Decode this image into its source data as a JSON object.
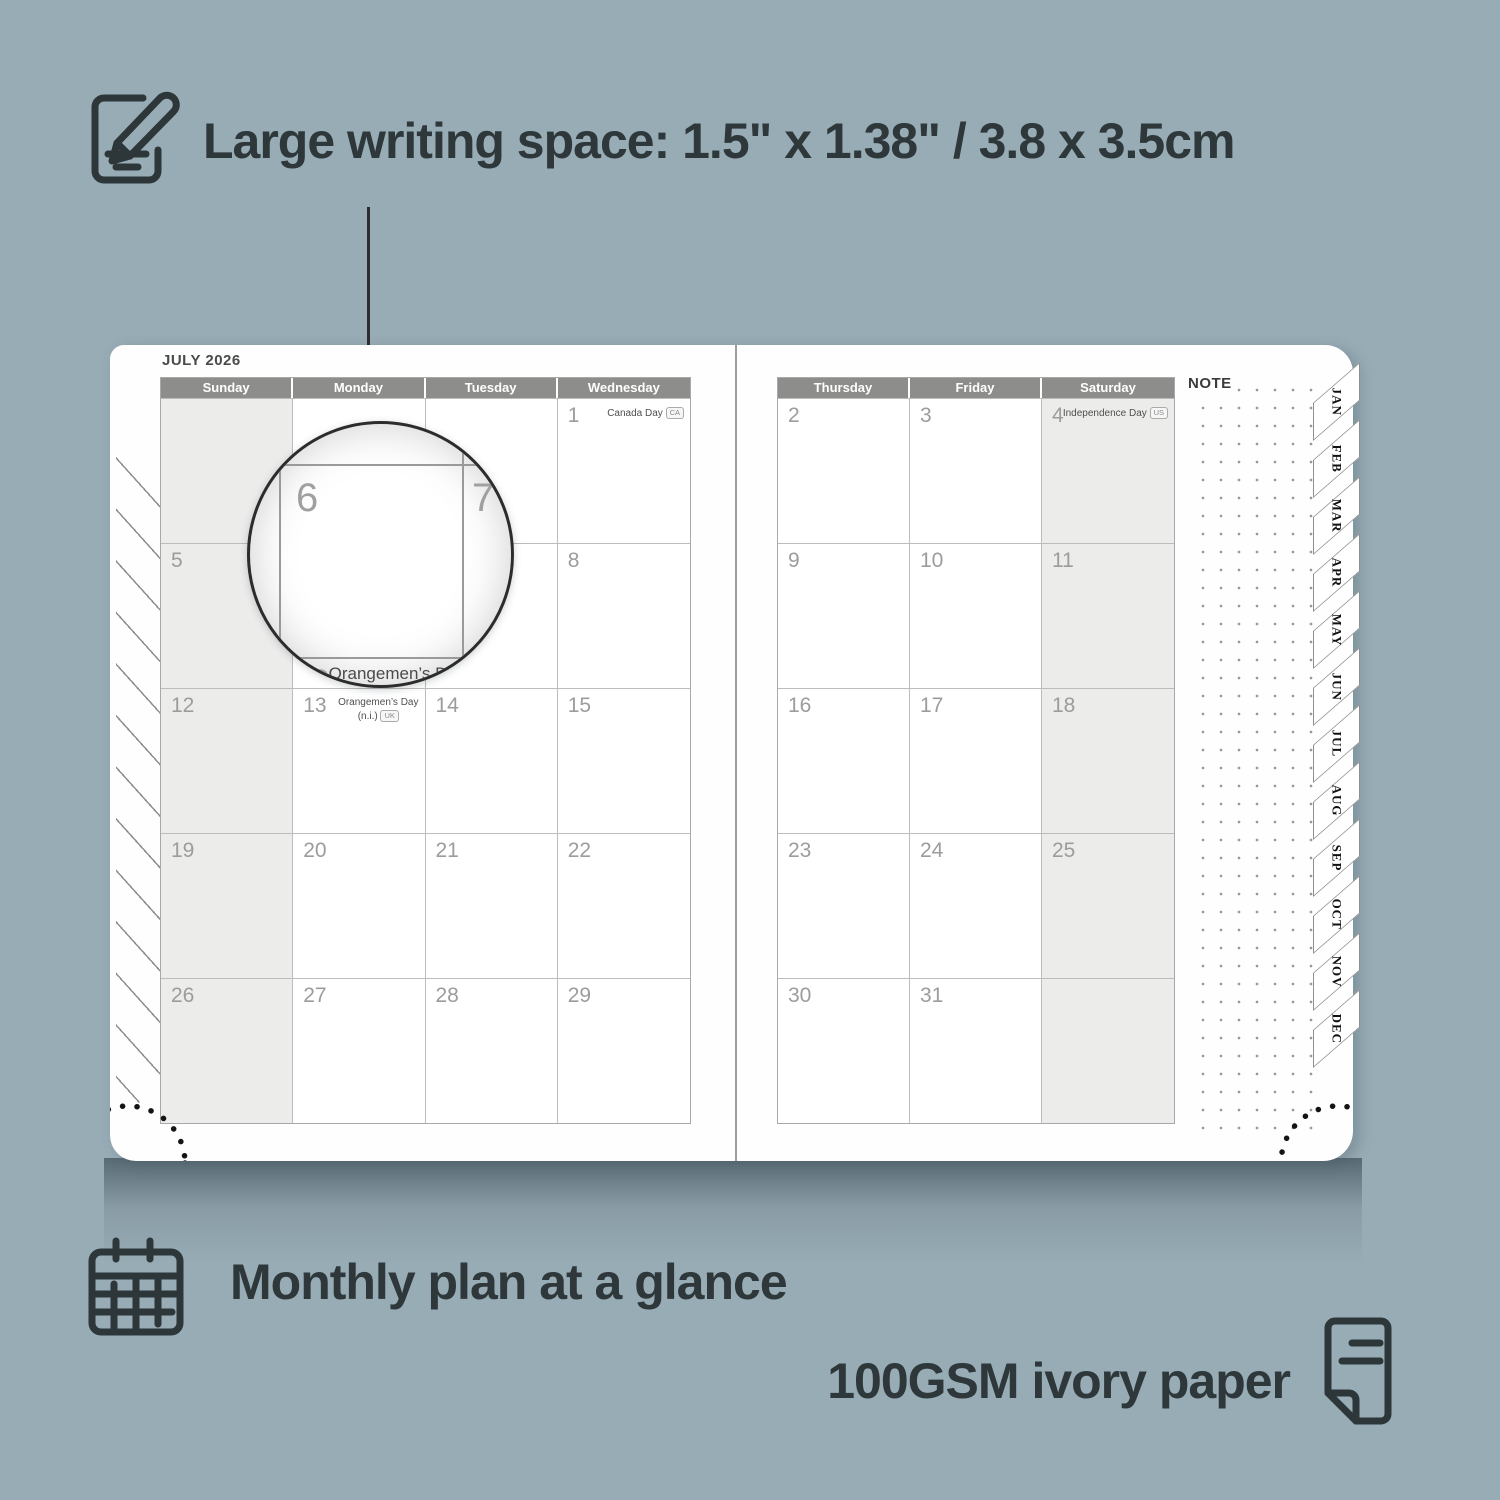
{
  "annotations": {
    "writing_space": {
      "icon": "notepad-pencil-icon",
      "text": "Large writing space: 1.5\" x 1.38\" / 3.8 x 3.5cm"
    },
    "monthly_plan": {
      "icon": "calendar-grid-icon",
      "text": "Monthly plan at a glance"
    },
    "paper": {
      "icon": "paper-sheet-icon",
      "text": "100GSM ivory paper"
    }
  },
  "planner": {
    "month_title": "JULY 2026",
    "note_label": "NOTE",
    "left_day_headers": [
      "Sunday",
      "Monday",
      "Tuesday",
      "Wednesday"
    ],
    "right_day_headers": [
      "Thursday",
      "Friday",
      "Saturday"
    ],
    "holidays": {
      "canada_day": {
        "name": "Canada Day",
        "badge": "CA"
      },
      "independence_day": {
        "name": "Independence Day",
        "badge": "US"
      },
      "orangemens_day": {
        "name": "Orangemen’s Day",
        "detail": "(n.i.)",
        "badge": "UK"
      }
    },
    "left_days": [
      [
        "",
        "",
        "",
        "1"
      ],
      [
        "5",
        "6",
        "7",
        "8"
      ],
      [
        "12",
        "13",
        "14",
        "15"
      ],
      [
        "19",
        "20",
        "21",
        "22"
      ],
      [
        "26",
        "27",
        "28",
        "29"
      ]
    ],
    "right_days": [
      [
        "2",
        "3",
        "4"
      ],
      [
        "9",
        "10",
        "11"
      ],
      [
        "16",
        "17",
        "18"
      ],
      [
        "23",
        "24",
        "25"
      ],
      [
        "30",
        "31",
        ""
      ]
    ],
    "month_tabs": [
      "JAN",
      "FEB",
      "MAR",
      "APR",
      "MAY",
      "JUN",
      "JUL",
      "AUG",
      "SEP",
      "OCT",
      "NOV",
      "DEC"
    ],
    "magnifier": {
      "day_a": "6",
      "day_b": "7",
      "day_c": "13",
      "holiday": "Orangemen’s Day",
      "holiday_detail": "(n.i.)",
      "holiday_badge": "UK"
    }
  },
  "colors": {
    "background": "#98acb6",
    "header_gray": "#8d8d8b",
    "accent_text": "#2e373a",
    "shaded_cell": "#ececeb"
  }
}
